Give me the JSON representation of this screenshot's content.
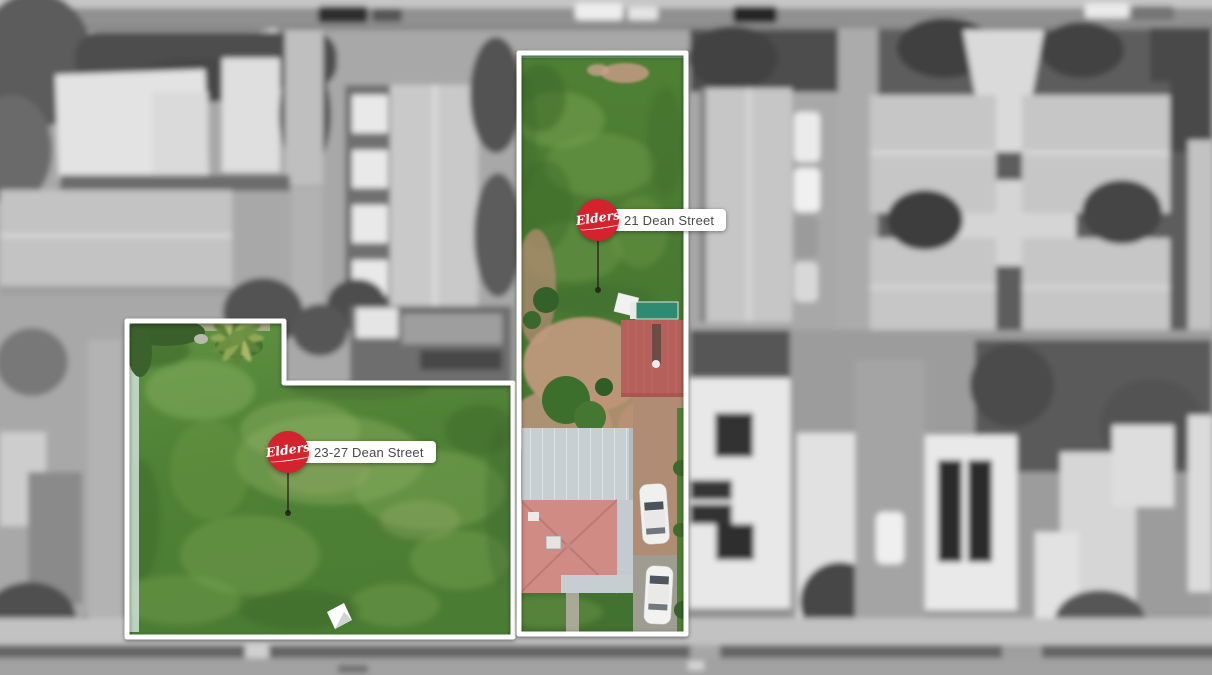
{
  "markers": [
    {
      "brand": "Elders",
      "address": "21 Dean Street"
    },
    {
      "brand": "Elders",
      "address": "23-27 Dean Street"
    }
  ],
  "colors": {
    "brand_red": "#d2232e",
    "label_bg": "#ffffff",
    "label_text": "#4a4a4a",
    "boundary": "#ffffff",
    "grass_base": "#558738",
    "shed_roof_red": "#b5605a",
    "house_roof_pink": "#d08b84",
    "house_roof_gray": "#c8cfd3",
    "driveway_tan": "#b18c74",
    "pool_teal": "#2f8a72"
  }
}
